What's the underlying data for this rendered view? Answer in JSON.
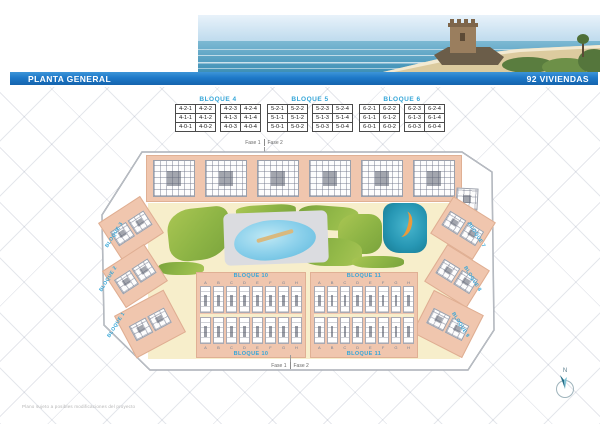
{
  "title_bar": {
    "left": "PLANTA GENERAL",
    "right": "92 VIVIENDAS"
  },
  "unit_tables": [
    {
      "title": "BLOQUE 4",
      "rows": [
        [
          "4-2-1",
          "4-2-2",
          "4-2-3",
          "4-2-4"
        ],
        [
          "4-1-1",
          "4-1-2",
          "4-1-3",
          "4-1-4"
        ],
        [
          "4-0-1",
          "4-0-2",
          "4-0-3",
          "4-0-4"
        ]
      ]
    },
    {
      "title": "BLOQUE 5",
      "rows": [
        [
          "5-2-1",
          "5-2-2",
          "5-2-3",
          "5-2-4"
        ],
        [
          "5-1-1",
          "5-1-2",
          "5-1-3",
          "5-1-4"
        ],
        [
          "5-0-1",
          "5-0-2",
          "5-0-3",
          "5-0-4"
        ]
      ]
    },
    {
      "title": "BLOQUE 6",
      "rows": [
        [
          "6-2-1",
          "6-2-2",
          "6-2-3",
          "6-2-4"
        ],
        [
          "6-1-1",
          "6-1-2",
          "6-1-3",
          "6-1-4"
        ],
        [
          "6-0-1",
          "6-0-2",
          "6-0-3",
          "6-0-4"
        ]
      ]
    }
  ],
  "phases": {
    "fase1": "Fase 1",
    "fase2": "Fase 2"
  },
  "site_plan": {
    "left_edge_labels": [
      "BLOQUE 3",
      "BLOQUE 2",
      "BLOQUE 1"
    ],
    "right_edge_labels": [
      "BLOQUE 7",
      "BLOQUE 8",
      "BLOQUE 9"
    ],
    "bottom_blocks": [
      {
        "label_top": "BLOQUE 10",
        "label_bottom": "BLOQUE 10",
        "letters": [
          "A",
          "B",
          "C",
          "D",
          "E",
          "F",
          "G",
          "H"
        ]
      },
      {
        "label_top": "BLOQUE 11",
        "label_bottom": "BLOQUE 11",
        "letters": [
          "A",
          "B",
          "C",
          "D",
          "E",
          "F",
          "G",
          "H"
        ]
      }
    ]
  },
  "compass": {
    "label": "N"
  },
  "disclaimer": "Plano sujeto a posibles modificaciones del proyecto",
  "colors": {
    "bar_blue": "#1e79c8",
    "accent_cyan": "#35a6d8",
    "salmon": "#f0c6ae",
    "beige": "#f7eecb",
    "pool_blue": "#8fd2ec",
    "waterpark_teal": "#2797b4",
    "slide_orange": "#eb9a3c",
    "green_light": "#a8c455",
    "green_dark": "#7aa33c"
  }
}
